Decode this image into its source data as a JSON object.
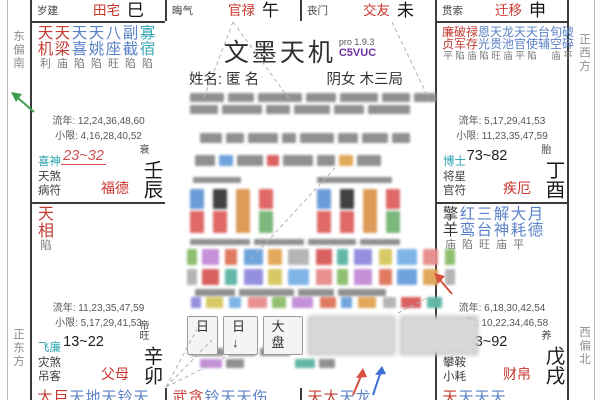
{
  "app": {
    "title": "文墨天机",
    "version": "pro 1.9.3",
    "code": "C5VUC"
  },
  "profile": {
    "name_label": "姓名:",
    "name": "匿 名",
    "info": "阴女 木三局"
  },
  "toolbar": {
    "buttons": [
      "日",
      "日↓",
      "大盘"
    ]
  },
  "compass": {
    "left_top": "东偏南",
    "left_bottom": "正东方",
    "right_top": "正西方",
    "right_bottom": "西偏北"
  },
  "colors": {
    "major_star": "#c43b32",
    "minor_star": "#5b82c8",
    "teal_star": "#3aa7b5",
    "dark_star": "#3a3a3a",
    "god_first": "#2ba3ad",
    "palace_name": "#c8362e",
    "status": "#787878",
    "accent_code": "#7030a0",
    "highlight_age": "#d05050",
    "arrow_red": "#d94f3d",
    "arrow_blue": "#3d6fd9",
    "arrow_green": "#3f9e4d",
    "grid": "#3c3c3c",
    "direction_text": "#8f8f8f"
  },
  "top_palaces": [
    {
      "god": "岁建",
      "palace": "田宅",
      "branch": "巳"
    },
    {
      "god": "晦气",
      "palace": "官禄",
      "branch": "午"
    },
    {
      "god": "丧门",
      "palace": "交友",
      "branch": "未"
    },
    {
      "god": "贯索",
      "palace": "迁移",
      "branch": "申"
    }
  ],
  "palaces": {
    "chen": {
      "stars": [
        {
          "n": "天机",
          "s": "利",
          "t": "major"
        },
        {
          "n": "天梁",
          "s": "庙",
          "t": "major"
        },
        {
          "n": "天喜",
          "s": "陷",
          "t": "minor"
        },
        {
          "n": "天姚",
          "s": "陷",
          "t": "minor"
        },
        {
          "n": "八座",
          "s": "旺",
          "t": "minor"
        },
        {
          "n": "副截",
          "s": "陷",
          "t": "minor"
        },
        {
          "n": "寡宿",
          "s": "陷",
          "t": "teal"
        }
      ],
      "liunian": "流年: 12,24,36,48,60",
      "xiaoxian": "小限: 4,16,28,40,52",
      "gods": [
        "喜神",
        "天煞",
        "病符"
      ],
      "age": "23~32",
      "age_highlight": true,
      "stage": "衰",
      "palace": "福德",
      "branch": "壬辰"
    },
    "you": {
      "stars": [
        {
          "n": "廉贞",
          "s": "平",
          "t": "major"
        },
        {
          "n": "破军",
          "s": "陷",
          "t": "major"
        },
        {
          "n": "禄存",
          "s": "庙",
          "t": "major"
        },
        {
          "n": "恩光",
          "s": "陷",
          "t": "minor"
        },
        {
          "n": "天贵",
          "s": "旺",
          "t": "minor"
        },
        {
          "n": "龙池",
          "s": "庙",
          "t": "minor"
        },
        {
          "n": "天官",
          "s": "平",
          "t": "minor"
        },
        {
          "n": "天使",
          "s": "陷",
          "t": "minor"
        },
        {
          "n": "台辅",
          "s": "",
          "t": "minor"
        },
        {
          "n": "旬空",
          "s": "庙",
          "t": "minor"
        },
        {
          "n": "破碎",
          "s": "平",
          "t": "minor"
        }
      ],
      "liunian": "流年: 5,17,29,41,53",
      "xiaoxian": "小限: 11,23,35,47,59",
      "gods": [
        "博士",
        "将星",
        "官符"
      ],
      "age": "73~82",
      "age_highlight": false,
      "stage": "胎",
      "palace": "疾厄",
      "branch": "丁酉"
    },
    "mao": {
      "stars": [
        {
          "n": "天相",
          "s": "陷",
          "t": "major"
        }
      ],
      "liunian": "流年: 11,23,35,47,59",
      "xiaoxian": "小限: 5,17,29,41,53",
      "gods": [
        "飞廉",
        "灾煞",
        "吊客"
      ],
      "age": "13~22",
      "age_highlight": false,
      "stage": "帝旺",
      "palace": "父母",
      "branch": "辛卯"
    },
    "xu": {
      "stars": [
        {
          "n": "擎羊",
          "s": "庙",
          "t": "dark"
        },
        {
          "n": "红鸾",
          "s": "陷",
          "t": "minor"
        },
        {
          "n": "三台",
          "s": "旺",
          "t": "minor"
        },
        {
          "n": "解神",
          "s": "庙",
          "t": "minor"
        },
        {
          "n": "大耗",
          "s": "平",
          "t": "minor"
        },
        {
          "n": "月德",
          "s": "",
          "t": "minor"
        }
      ],
      "liunian": "流年: 6,18,30,42,54",
      "xiaoxian": "小限: 10,22,34,46,58",
      "gods": [
        "力士",
        "攀鞍",
        "小耗"
      ],
      "age": "83~92",
      "age_highlight": false,
      "stage": "养",
      "palace": "财帛",
      "branch": "戊戌"
    }
  },
  "bottom_palaces": [
    {
      "chars": [
        [
          "太",
          "major"
        ],
        [
          "巨",
          "major"
        ],
        [
          "天",
          "minor"
        ],
        [
          "地",
          "minor"
        ],
        [
          "天",
          "minor"
        ],
        [
          "铃",
          "minor"
        ],
        [
          "天",
          "minor"
        ]
      ]
    },
    {
      "chars": [
        [
          "武",
          "major"
        ],
        [
          "贪",
          "major"
        ],
        [
          "铃",
          "minor"
        ],
        [
          "天",
          "minor"
        ],
        [
          "天",
          "minor"
        ],
        [
          "伤",
          "minor"
        ]
      ]
    },
    {
      "chars": [
        [
          "天",
          "major"
        ],
        [
          "太",
          "major"
        ],
        [
          "天",
          "minor"
        ],
        [
          "龙",
          "minor"
        ]
      ]
    },
    {
      "chars": [
        [
          "天",
          "major"
        ],
        [
          "天",
          "minor"
        ],
        [
          "天",
          "minor"
        ],
        [
          "天",
          "minor"
        ]
      ]
    }
  ],
  "redacted": {
    "gray": "#909090",
    "tag_palette": [
      "#8fbf6f",
      "#c490d8",
      "#e07b62",
      "#6fa3dc",
      "#e2a75a",
      "#b5b5b5",
      "#d96060",
      "#62b7a8",
      "#958fe0",
      "#d8c964",
      "#7fb4e8",
      "#e88f8f"
    ],
    "pillar_columns": [
      {
        "top": "#6b9bd8",
        "bottom": "#e06868"
      },
      {
        "top": "#414141",
        "bottom": "#e06868"
      },
      {
        "top": "#dd9a58",
        "bottom": "#dd9a58"
      },
      {
        "top": "#e06868",
        "bottom": "#7cb87c"
      }
    ]
  }
}
